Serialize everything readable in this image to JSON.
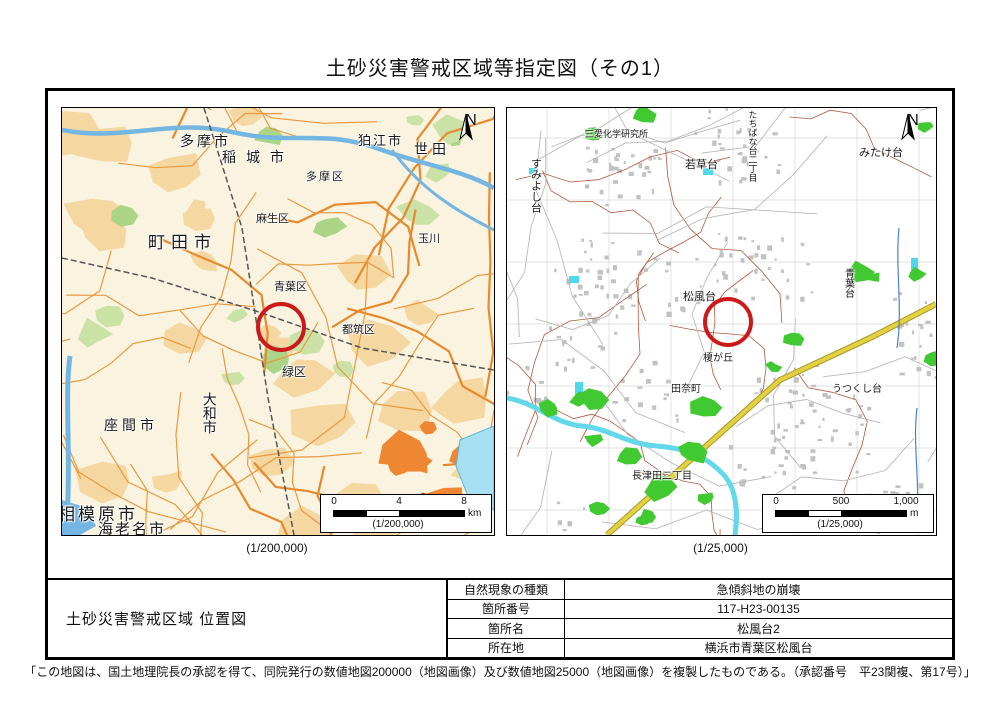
{
  "title": "土砂災害警戒区域等指定図（その1）",
  "maps": {
    "left": {
      "caption": "(1/200,000)",
      "north_label": "N",
      "scale_ticks": [
        "0",
        "4",
        "8"
      ],
      "scale_unit": "km",
      "scale_ratio": "(1/200,000)",
      "labels": [
        {
          "text": "多摩市"
        },
        {
          "text": "稲城市"
        },
        {
          "text": "狛江市"
        },
        {
          "text": "世田"
        },
        {
          "text": "玉川"
        },
        {
          "text": "多摩区"
        },
        {
          "text": "麻生区"
        },
        {
          "text": "町田市"
        },
        {
          "text": "青葉区"
        },
        {
          "text": "都筑区"
        },
        {
          "text": "緑区"
        },
        {
          "text": "大和市"
        },
        {
          "text": "座間市"
        },
        {
          "text": "相模原市"
        },
        {
          "text": "海老名市"
        },
        {
          "text": "港北区"
        }
      ]
    },
    "right": {
      "caption": "(1/25,000)",
      "north_label": "N",
      "scale_ticks": [
        "0",
        "500",
        "1,000"
      ],
      "scale_unit": "m",
      "scale_ratio": "(1/25,000)",
      "labels": [
        {
          "text": "すみよし台"
        },
        {
          "text": "三愛化学研究所"
        },
        {
          "text": "若草台"
        },
        {
          "text": "たちばな台二丁目"
        },
        {
          "text": "みたけ台"
        },
        {
          "text": "松風台"
        },
        {
          "text": "青葉台"
        },
        {
          "text": "榎が丘"
        },
        {
          "text": "田奈町"
        },
        {
          "text": "長津田二丁目"
        },
        {
          "text": "うつくし台"
        }
      ]
    }
  },
  "info_panel": {
    "map_title": "土砂災害警戒区域 位置図",
    "rows": [
      {
        "label": "自然現象の種類",
        "value": "急傾斜地の崩壊"
      },
      {
        "label": "箇所番号",
        "value": "117-H23-00135"
      },
      {
        "label": "箇所名",
        "value": "松風台2"
      },
      {
        "label": "所在地",
        "value": "横浜市青葉区松風台"
      }
    ]
  },
  "footer_note": "「この地図は、国土地理院長の承認を得て、同院発行の数値地図200000（地図画像）及び数値地図25000（地図画像）を複製したものである。（承認番号　平23関複、第17号）」",
  "colors": {
    "marker_red": "#cc1a1a",
    "road_orange": "#e9993f",
    "urban_tan": "#f5d7a2",
    "dense_urban_orange": "#ef8632",
    "dense_urban_red": "#d93a3a",
    "water_blue": "#74b6e2",
    "water_cyan": "#62d8ea",
    "park_green": "#41c932",
    "contour_brown": "#b05a3c",
    "main_road_yellow": "#e3d13f"
  }
}
